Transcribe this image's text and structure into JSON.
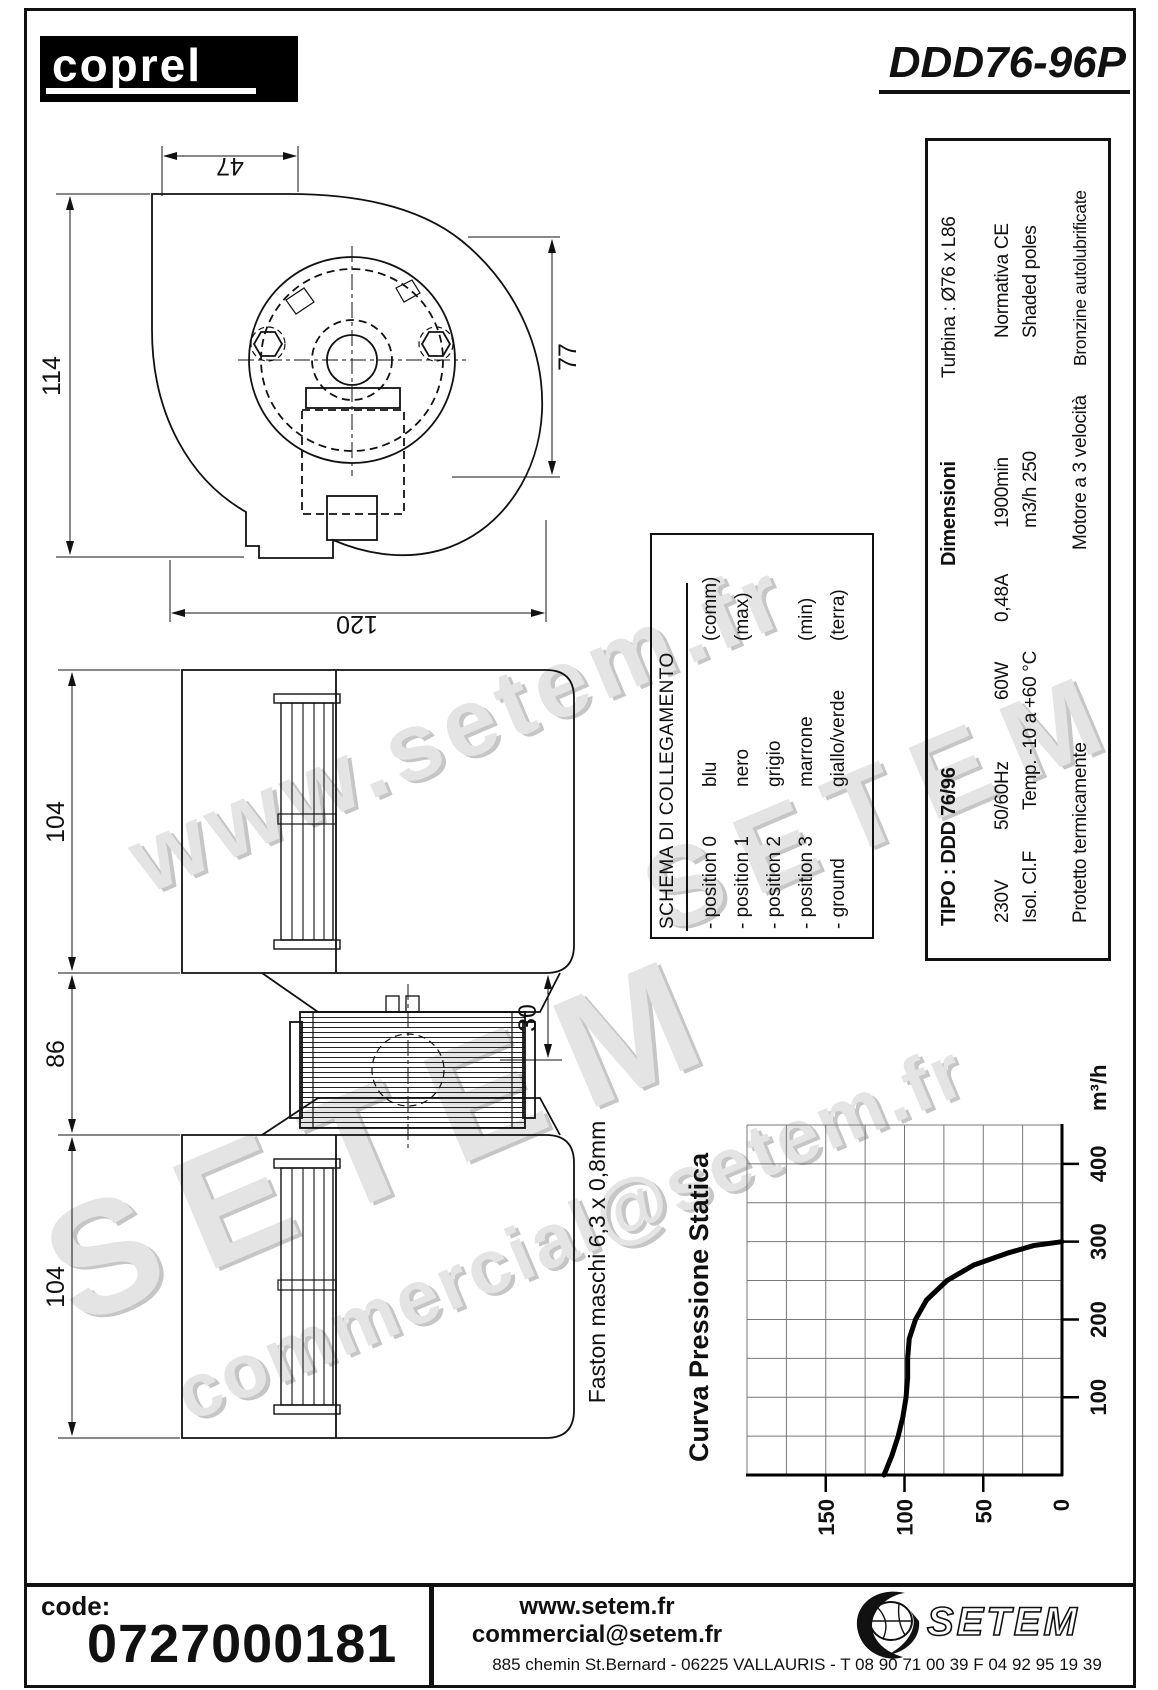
{
  "header": {
    "logo_text": "coprel",
    "model": "DDD76-96P"
  },
  "spec_table": {
    "tipo": "TIPO : DDD 76/96",
    "dim_label": "Dimensioni",
    "turbina": "Turbina : Ø76 x L86",
    "voltage": "230V",
    "frequency": "50/60Hz",
    "power": "60W",
    "current": "0,48A",
    "speed": "1900min",
    "norm": "Normativa CE",
    "insulation": "Isol. Cl.F",
    "temp": "Temp. -10 a +60 °C",
    "flow": "m3/h 250",
    "poles": "Shaded poles",
    "protection": "Protetto termicamente",
    "motor": "Motore a 3 velocità",
    "bearings": "Bronzine autolubrificate"
  },
  "schema": {
    "title": "SCHEMA DI COLLEGAMENTO",
    "rows": [
      {
        "label": "- position 0",
        "color": "blu",
        "note": "(comm)"
      },
      {
        "label": "- position 1",
        "color": "nero",
        "note": "(max)"
      },
      {
        "label": "- position 2",
        "color": "grigio",
        "note": ""
      },
      {
        "label": "- position 3",
        "color": "marrone",
        "note": "(min)"
      },
      {
        "label": "- ground",
        "color": "giallo/verde",
        "note": "(terra)"
      }
    ]
  },
  "dims": {
    "top_width": "47",
    "height": "114",
    "total_width": "120",
    "inlet": "77",
    "housing_upper": "104",
    "motor_gap": "86",
    "housing_lower": "104",
    "shaft_offset": "30"
  },
  "faston_note": "Faston maschi 6,3 x 0,8mm",
  "chart_data": {
    "type": "line",
    "title": "Curva Pressione Statica",
    "xlabel": "m³/h",
    "ylabel": "",
    "note": "chart is printed rotated 90° CCW on page; flow axis vertical",
    "xlim": [
      0,
      450
    ],
    "ylim": [
      0,
      200
    ],
    "grid_step_x": 50,
    "grid_step_y": 25,
    "x_ticks": [
      100,
      200,
      300,
      400
    ],
    "y_ticks": [
      0,
      50,
      100,
      150
    ],
    "grid": true,
    "series": [
      {
        "name": "static pressure (Pa) vs flow (m3/h)",
        "points": [
          [
            0,
            113
          ],
          [
            25,
            108
          ],
          [
            50,
            104
          ],
          [
            75,
            101
          ],
          [
            100,
            99
          ],
          [
            125,
            98
          ],
          [
            150,
            98
          ],
          [
            175,
            97
          ],
          [
            200,
            93
          ],
          [
            225,
            86
          ],
          [
            250,
            73
          ],
          [
            270,
            56
          ],
          [
            285,
            35
          ],
          [
            295,
            18
          ],
          [
            300,
            0
          ]
        ]
      }
    ]
  },
  "watermarks": {
    "wm1": "www.setem.fr",
    "wm2": "SETEM",
    "wm3": "commercial@setem.fr",
    "wm4": "SETEM"
  },
  "footer": {
    "code_label": "code:",
    "code_value": "0727000181",
    "web": "www.setem.fr",
    "email": "commercial@setem.fr",
    "address": "885 chemin St.Bernard  -  06225 VALLAURIS  -  T 08 90 71 00 39   F 04 92 95 19 39",
    "brand": "SETEM"
  }
}
